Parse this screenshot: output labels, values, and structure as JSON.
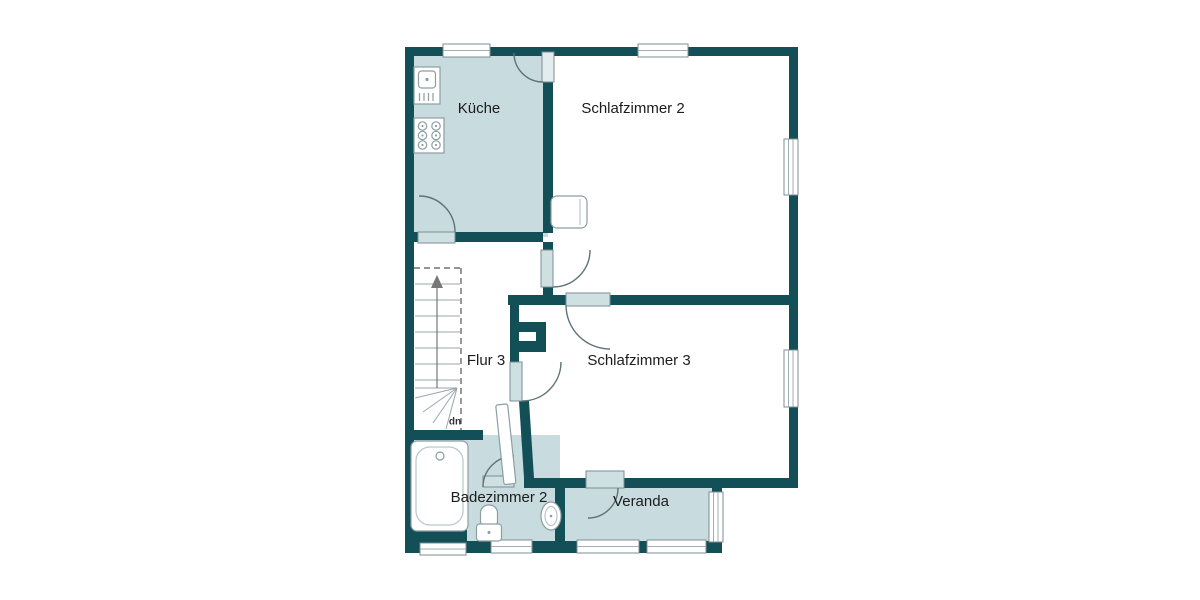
{
  "floor_plan": {
    "rooms": [
      {
        "id": "kueche",
        "label": "Küche"
      },
      {
        "id": "schlafzimmer-2",
        "label": "Schlafzimmer 2"
      },
      {
        "id": "flur-3",
        "label": "Flur 3"
      },
      {
        "id": "schlafzimmer-3",
        "label": "Schlafzimmer 3"
      },
      {
        "id": "badezimmer-2",
        "label": "Badezimmer 2"
      },
      {
        "id": "veranda",
        "label": "Veranda"
      }
    ],
    "stairs": {
      "direction_label": "up"
    },
    "fixtures": [
      "kitchen-sink",
      "stove-6-burner",
      "bathtub",
      "toilet",
      "washbasin",
      "stairs",
      "chimney",
      "cabinet"
    ],
    "colors": {
      "wall": "#134F57",
      "room_fill": "#C8DBDE",
      "background": "#FFFFFF",
      "window_stroke": "#7C8E93",
      "fixture_stroke": "#8C9EA3",
      "label_color": "#1C1C1C"
    }
  }
}
